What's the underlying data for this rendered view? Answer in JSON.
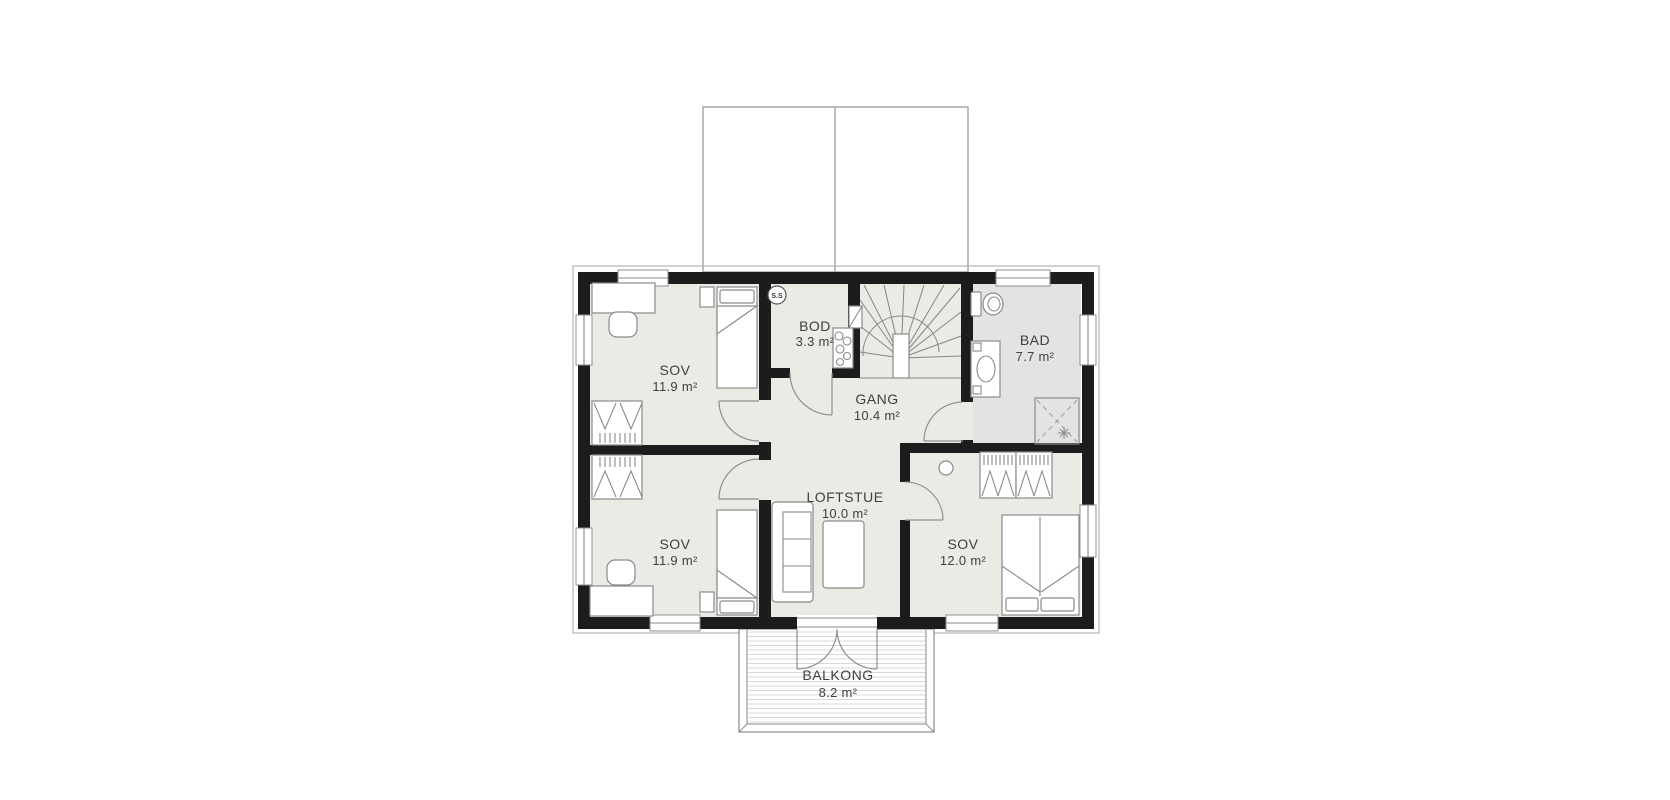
{
  "rooms": [
    {
      "name": "SOV",
      "area": "11.9 m²"
    },
    {
      "name": "BOD",
      "area": "3.3 m²"
    },
    {
      "name": "BAD",
      "area": "7.7 m²"
    },
    {
      "name": "GANG",
      "area": "10.4 m²"
    },
    {
      "name": "SOV",
      "area": "11.9 m²"
    },
    {
      "name": "LOFTSTUE",
      "area": "10.0 m²"
    },
    {
      "name": "SOV",
      "area": "12.0 m²"
    },
    {
      "name": "BALKONG",
      "area": "8.2 m²"
    }
  ],
  "markers": {
    "smoke_detector": "S.S"
  },
  "colors": {
    "wall": "#1c1c1c",
    "floor": "#ebeae5",
    "bathroom_floor": "#e2e3e5",
    "line": "#8a8a8a",
    "deck": "#d8d8d8",
    "text": "#3f3f3f"
  }
}
